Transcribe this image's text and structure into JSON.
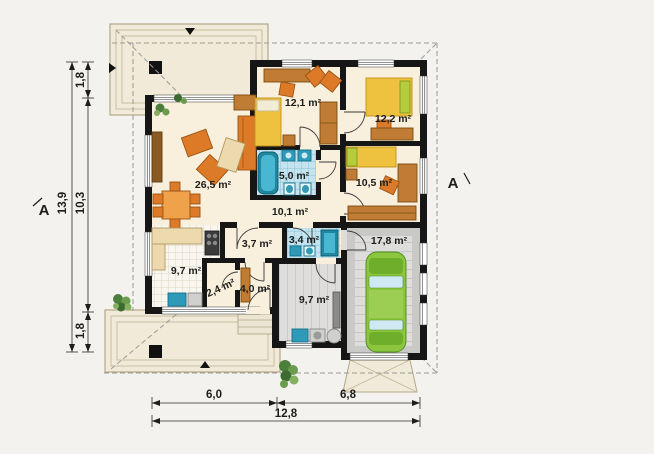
{
  "rooms": {
    "living_room": {
      "area": "26,5 m²"
    },
    "bedroom_1": {
      "area": "12,1 m²"
    },
    "bedroom_2": {
      "area": "12,2 m²"
    },
    "bathroom": {
      "area": "5,0 m²"
    },
    "bedroom_3": {
      "area": "10,5 m²"
    },
    "hall": {
      "area": "10,1 m²"
    },
    "corridor": {
      "area": "3,7 m²"
    },
    "wc": {
      "area": "3,4 m²"
    },
    "garage": {
      "area": "17,8 m²"
    },
    "kitchen": {
      "area": "9,7 m²"
    },
    "pantry": {
      "area": "2,4 m²"
    },
    "entry": {
      "area": "4,0 m²"
    },
    "utility": {
      "area": "9,7 m²"
    }
  },
  "dimensions": {
    "left_total": "13,9",
    "left_main": "10,3",
    "left_top": "1,8",
    "left_bottom": "1,8",
    "bottom_left": "6,0",
    "bottom_right": "6,8",
    "bottom_total": "12,8"
  },
  "section": {
    "left": "A",
    "right": "A"
  },
  "colors": {
    "background": "#f3f2ef",
    "floor_cream": "#f8efdc",
    "wall_black": "#161616",
    "furniture_orange": "#dd7a28",
    "bed_yellow": "#eec23f",
    "wood_brown": "#c07c34",
    "tile_blue": "#c3e4ef",
    "fixture_teal": "#1f87a0",
    "garage_gray": "#dedddb",
    "car_green": "#8cc63e",
    "terrace_beige": "#f1ead8"
  }
}
